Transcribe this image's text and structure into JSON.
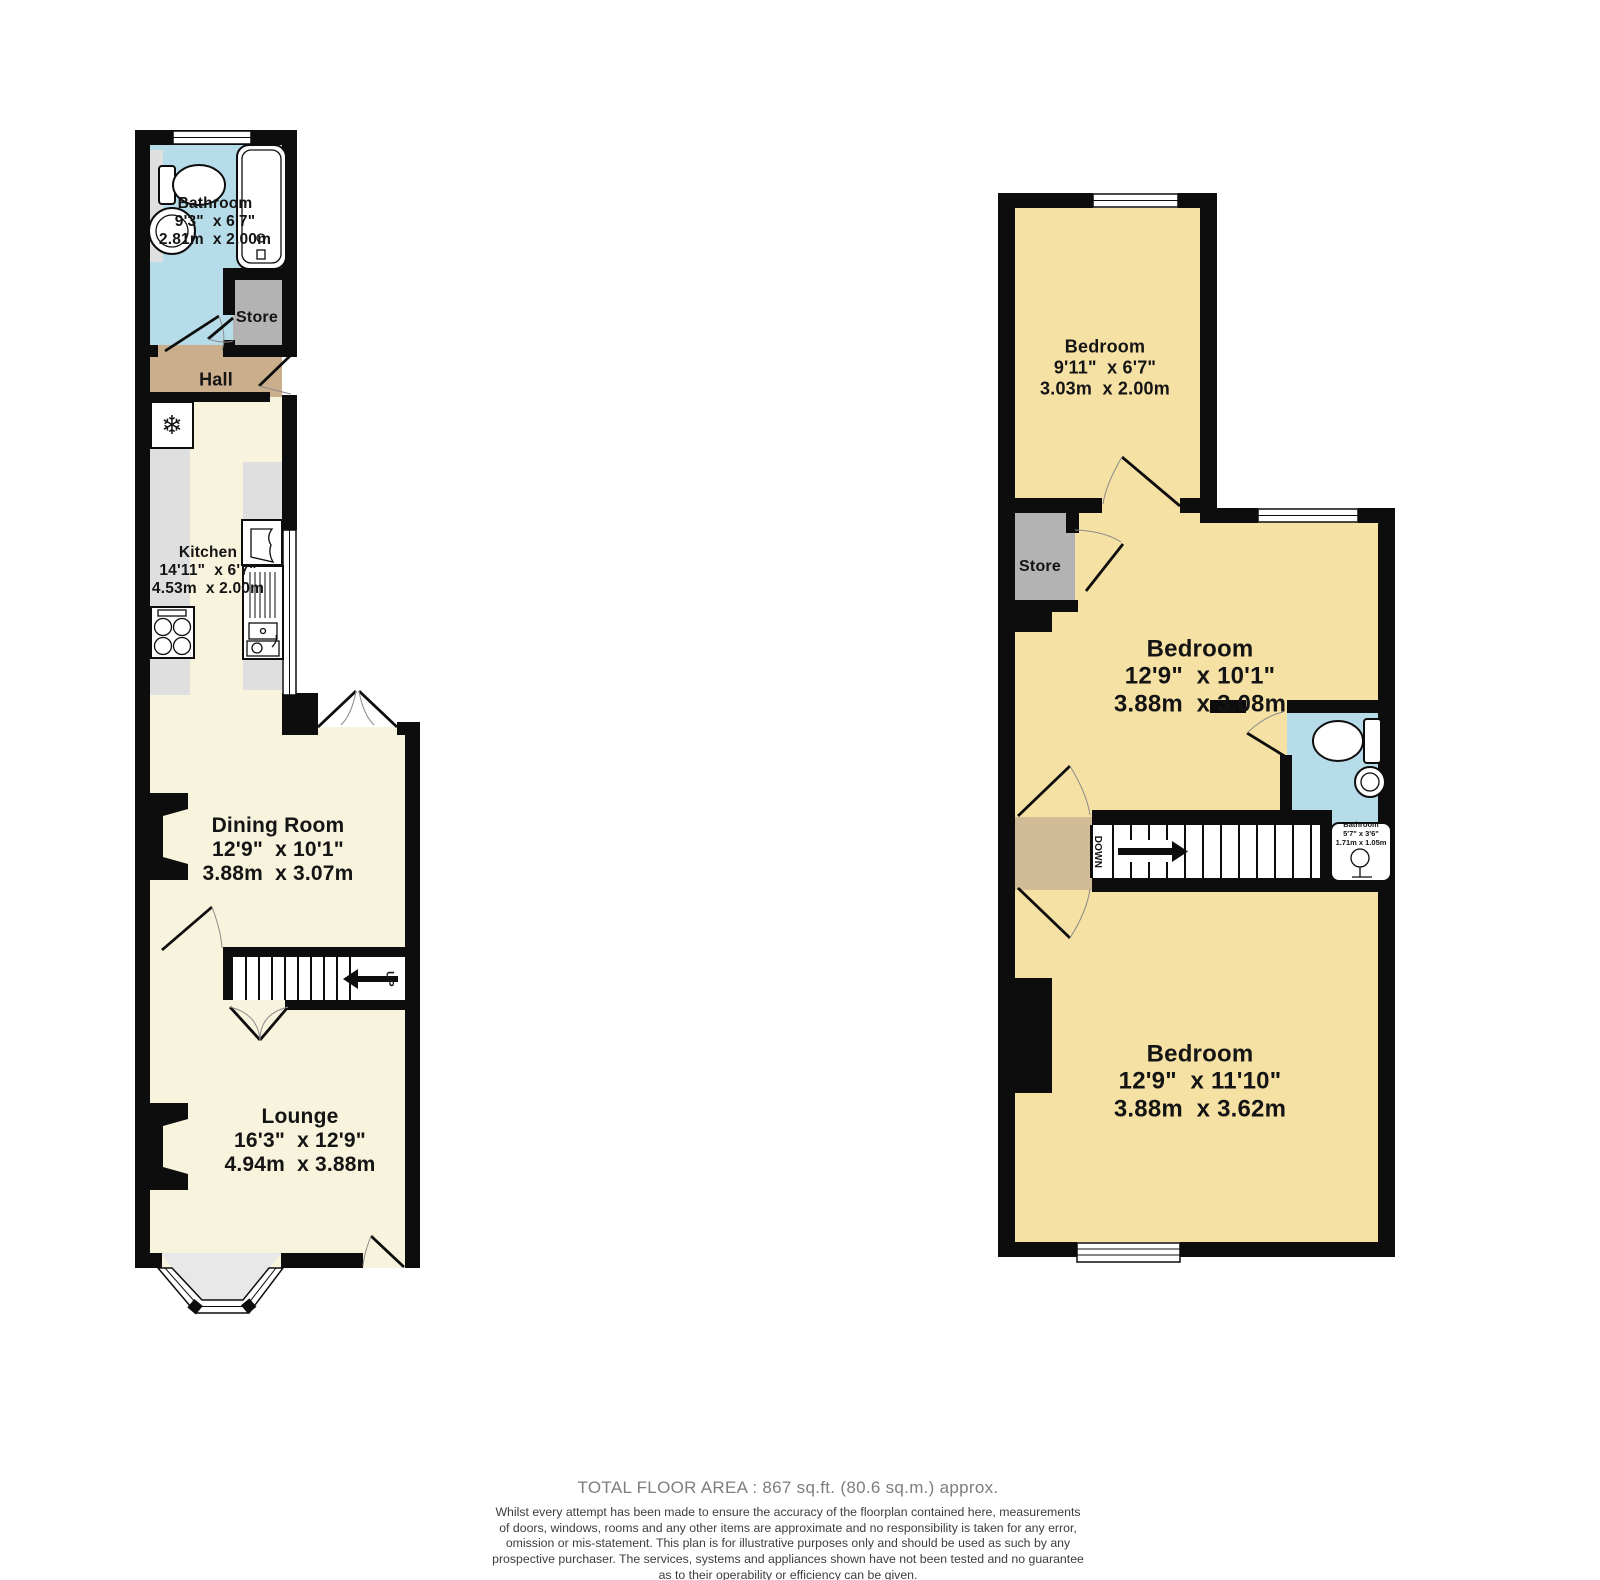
{
  "ground_floor": {
    "bathroom": {
      "name": "Bathroom",
      "imperial": "9'3\"  x 6'7\"",
      "metric": "2.81m  x 2.00m"
    },
    "store": {
      "name": "Store"
    },
    "hall": {
      "name": "Hall"
    },
    "kitchen": {
      "name": "Kitchen",
      "imperial": "14'11\"  x 6'7\"",
      "metric": "4.53m  x 2.00m"
    },
    "dining": {
      "name": "Dining Room",
      "imperial": "12'9\"  x 10'1\"",
      "metric": "3.88m  x 3.07m"
    },
    "lounge": {
      "name": "Lounge",
      "imperial": "16'3\"  x 12'9\"",
      "metric": "4.94m  x 3.88m"
    },
    "stairs_label": "UP"
  },
  "first_floor": {
    "bedroom_top": {
      "name": "Bedroom",
      "imperial": "9'11\"  x 6'7\"",
      "metric": "3.03m  x 2.00m"
    },
    "store": {
      "name": "Store"
    },
    "bedroom_mid": {
      "name": "Bedroom",
      "imperial": "12'9\"  x 10'1\"",
      "metric": "3.88m  x 3.08m"
    },
    "bathroom": {
      "name": "Bathroom",
      "imperial": "5'7\" x 3'6\"",
      "metric": "1.71m x 1.05m"
    },
    "bedroom_bot": {
      "name": "Bedroom",
      "imperial": "12'9\"  x 11'10\"",
      "metric": "3.88m  x 3.62m"
    },
    "stairs_label": "DOWN"
  },
  "footer": {
    "total_area": "TOTAL FLOOR AREA : 867 sq.ft. (80.6 sq.m.) approx.",
    "disclaimer_lines": [
      "Whilst every attempt has been made to ensure the accuracy of the floorplan contained here, measurements",
      "of doors, windows, rooms and any other items are approximate and no responsibility is taken for any error,",
      "omission or mis-statement. This plan is for illustrative purposes only and should be used as such by any",
      "prospective purchaser. The services, systems and appliances shown have not been tested and no guarantee",
      "as to their operability or efficiency can be given."
    ],
    "credit": "Made with Metropix ©2026"
  },
  "colors": {
    "wall": "#0d0d0d",
    "room_cream": "#F8F3DC",
    "room_yellow": "#F5E1A4",
    "room_blue": "#B7DCE9",
    "hall_tan": "#CBAE8B",
    "landing_tan": "#D2BB97",
    "store_gray": "#B3B3B3",
    "counter_gray": "#DFDFDF",
    "bay_gray": "#E8E8E8",
    "footer_gray": "#7E7E7E",
    "text_dark": "#141414"
  }
}
